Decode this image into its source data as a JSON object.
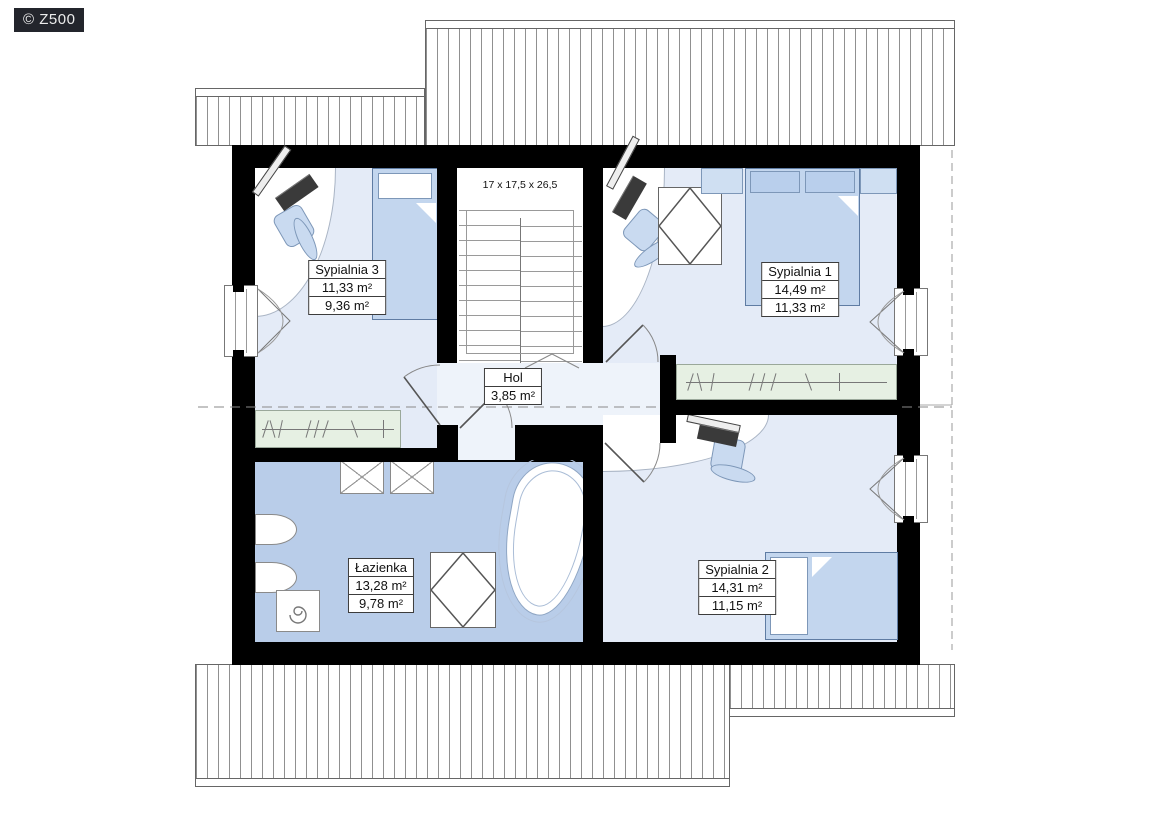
{
  "logo": {
    "text": "© Z500"
  },
  "stairs": {
    "dimensions": "17 x 17,5 x 26,5"
  },
  "rooms": {
    "sypialnia3": {
      "name": "Sypialnia 3",
      "area_total": "11,33 m²",
      "area_usable": "9,36 m²"
    },
    "sypialnia1": {
      "name": "Sypialnia 1",
      "area_total": "14,49 m²",
      "area_usable": "11,33 m²"
    },
    "hol": {
      "name": "Hol",
      "area_total": "3,85 m²"
    },
    "lazienka": {
      "name": "Łazienka",
      "area_total": "13,28 m²",
      "area_usable": "9,78 m²"
    },
    "sypialnia2": {
      "name": "Sypialnia 2",
      "area_total": "14,31 m²",
      "area_usable": "11,15 m²"
    }
  },
  "colors": {
    "wall": "#000000",
    "floor_bedroom": "#e4ebf7",
    "floor_hall": "#eef3fa",
    "floor_bathroom": "#b9cde9",
    "wardrobe": "#e6f0e3",
    "furniture_fill": "#c3d6ee",
    "furniture_border": "#5f7ca3",
    "roof_line": "#909090"
  }
}
